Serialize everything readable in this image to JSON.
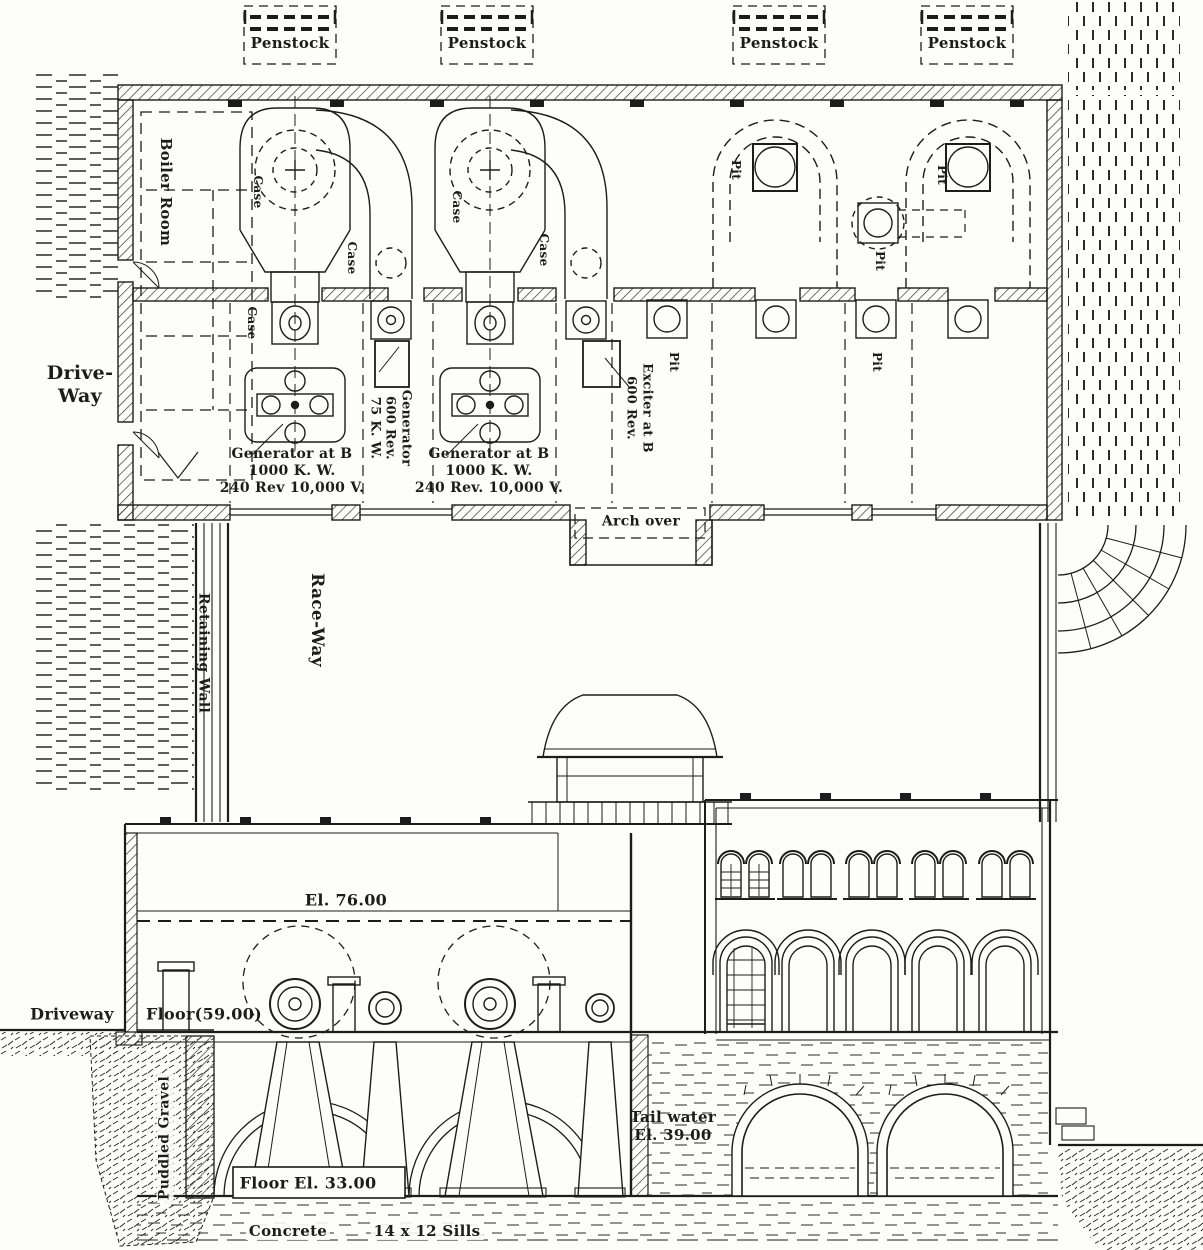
{
  "figure": {
    "kind": "power-house plan and sectional elevation drawing",
    "paper_color": "#fdfdfb",
    "ink_color": "#1c1c1c"
  },
  "plan": {
    "penstocks": [
      "Penstock",
      "Penstock",
      "Penstock",
      "Penstock"
    ],
    "boiler_room": "Boiler Room",
    "drive_way": [
      "Drive-",
      "Way"
    ],
    "cases": [
      "Case",
      "Case",
      "Case",
      "Case",
      "Case"
    ],
    "generator_left": [
      "Generator at B",
      "1000 K. W.",
      "240 Rev  10,000 V."
    ],
    "generator_right": [
      "Generator at B",
      "1000 K. W.",
      "240 Rev. 10,000 V."
    ],
    "small_generator": [
      "Generator",
      "600 Rev.",
      "75 K. W."
    ],
    "exciter": [
      "Exciter at B",
      "600 Rev."
    ],
    "pits": [
      "Pit",
      "Pit",
      "Pit",
      "Pit",
      "Pit"
    ],
    "arch_over": "Arch over"
  },
  "raceway": {
    "race_way": "Race-Way",
    "retaining_wall": "Retaining Wall"
  },
  "elevation": {
    "el_76": "El. 76.00",
    "driveway": "Driveway",
    "floor_59": "Floor(59.00)",
    "puddled_gravel": "Puddled Gravel",
    "floor_33": "Floor El. 33.00",
    "tail_water": [
      "Tail water",
      "El. 39.00"
    ],
    "concrete": "Concrete",
    "sills": "14 x 12 Sills"
  }
}
